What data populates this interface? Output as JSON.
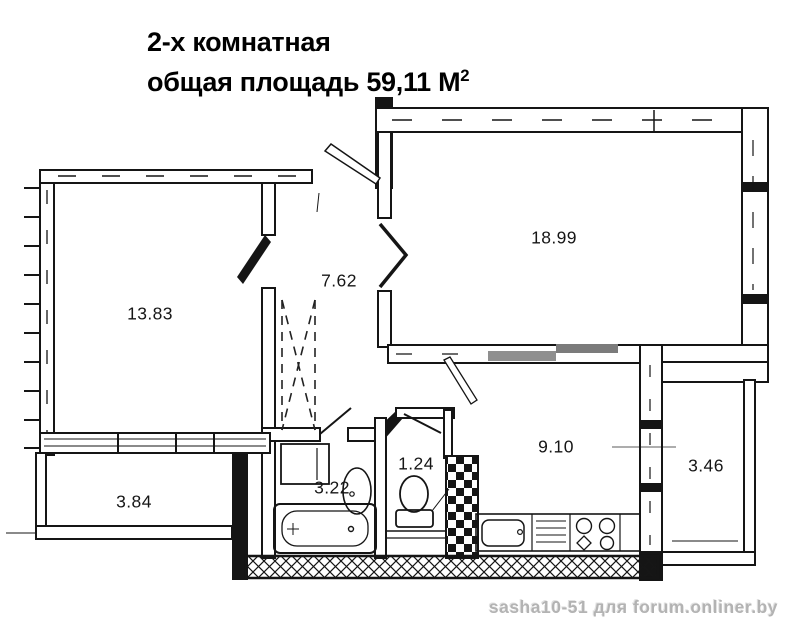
{
  "title": {
    "line1": "2-х комнатная",
    "line2": "общая площадь 59,11 М",
    "line2_sup": "2"
  },
  "floor_plan": {
    "type": "apartment-floor-plan",
    "total_area_m2": "59,11",
    "rooms": [
      {
        "id": "living-room",
        "area": "13.83"
      },
      {
        "id": "hallway",
        "area": "7.62"
      },
      {
        "id": "bedroom",
        "area": "18.99"
      },
      {
        "id": "kitchen",
        "area": "9.10"
      },
      {
        "id": "balcony-right",
        "area": "3.46"
      },
      {
        "id": "balcony-left",
        "area": "3.84"
      },
      {
        "id": "bathroom",
        "area": "3.22"
      },
      {
        "id": "toilet",
        "area": "1.24"
      }
    ],
    "fixtures": [
      "bathtub",
      "bathroom-sink",
      "washing-machine",
      "toilet-bowl",
      "kitchen-sink",
      "stove",
      "ventilation-shaft",
      "wardrobe"
    ],
    "colors": {
      "line": "#151515",
      "smudge": "#8a8a8a",
      "background": "#ffffff"
    }
  },
  "watermark": {
    "text": "sasha10-51 для forum.onliner.by"
  }
}
